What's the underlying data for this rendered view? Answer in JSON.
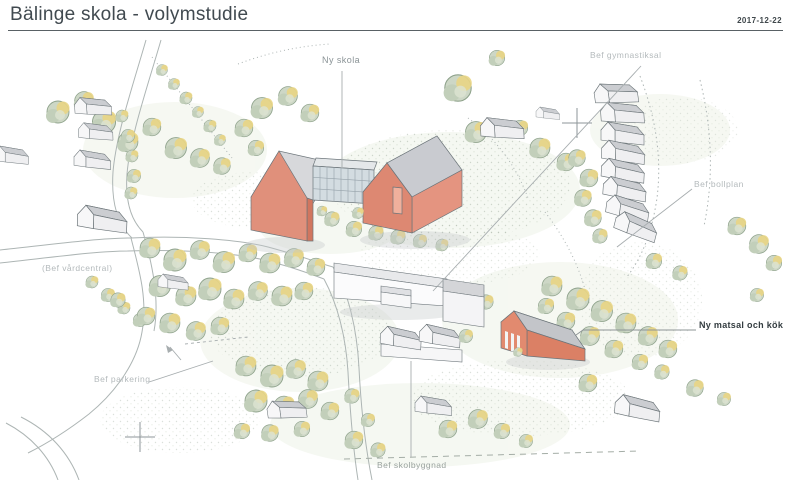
{
  "slide": {
    "title": "Bälinge skola - volymstudie",
    "date": "2017-12-22"
  },
  "annotations": {
    "ny_skola": "Ny skola",
    "bef_gymnastiksal": "Bef gymnastiksal",
    "bef_bollplan": "Bef bollplan",
    "bef_vardcentral": "(Bef vårdcentral)",
    "ny_matsal_och_kok": "Ny matsal och kök",
    "bef_parkering": "Bef parkering",
    "bef_skolbyggnad": "Bef skolbyggnad"
  },
  "palette": {
    "new_building": "#e0907b",
    "new_building_shadow": "#d1765f",
    "roof_grey": "#d6d7da",
    "glass_link": "#d3dce1",
    "tree_green": "#cdd7c6",
    "tree_highlight": "#e9d584",
    "label_light": "#b4babc",
    "label_dark": "#333c40",
    "title_color": "#414a50"
  }
}
